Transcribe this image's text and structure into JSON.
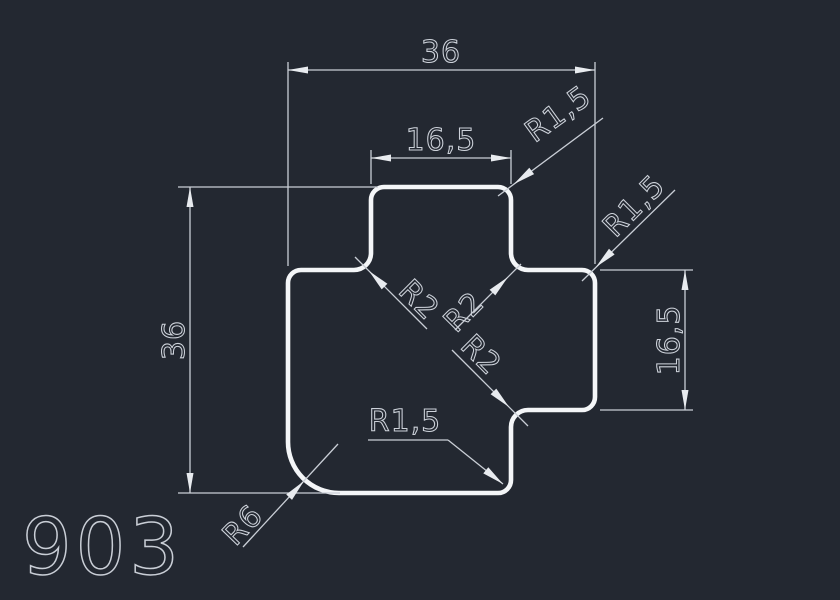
{
  "canvas": {
    "width": 840,
    "height": 600,
    "background_color": "#232831",
    "outline_color": "#f4f6f8",
    "dimension_color": "#c9ced6",
    "text_color": "#cdd2da"
  },
  "part": {
    "number": "903"
  },
  "dimensions": {
    "overall_width": "36",
    "top_tab_width": "16,5",
    "overall_height": "36",
    "right_tab_height": "16,5"
  },
  "radii": {
    "top_tab_corner": "R1,5",
    "right_tab_corner": "R1,5",
    "bottom_step_corner": "R1,5",
    "left_notch_fillet": "R2",
    "upper_notch_fillet": "R2",
    "lower_notch_fillet": "R2",
    "bottom_left_corner": "R6"
  },
  "geometry_mm": {
    "overall_width": 36,
    "overall_height": 36,
    "top_tab_width": 16.5,
    "right_tab_height": 16.5,
    "small_corner_radius": 1.5,
    "notch_fillet_radius": 2,
    "bottom_left_radius": 6
  }
}
